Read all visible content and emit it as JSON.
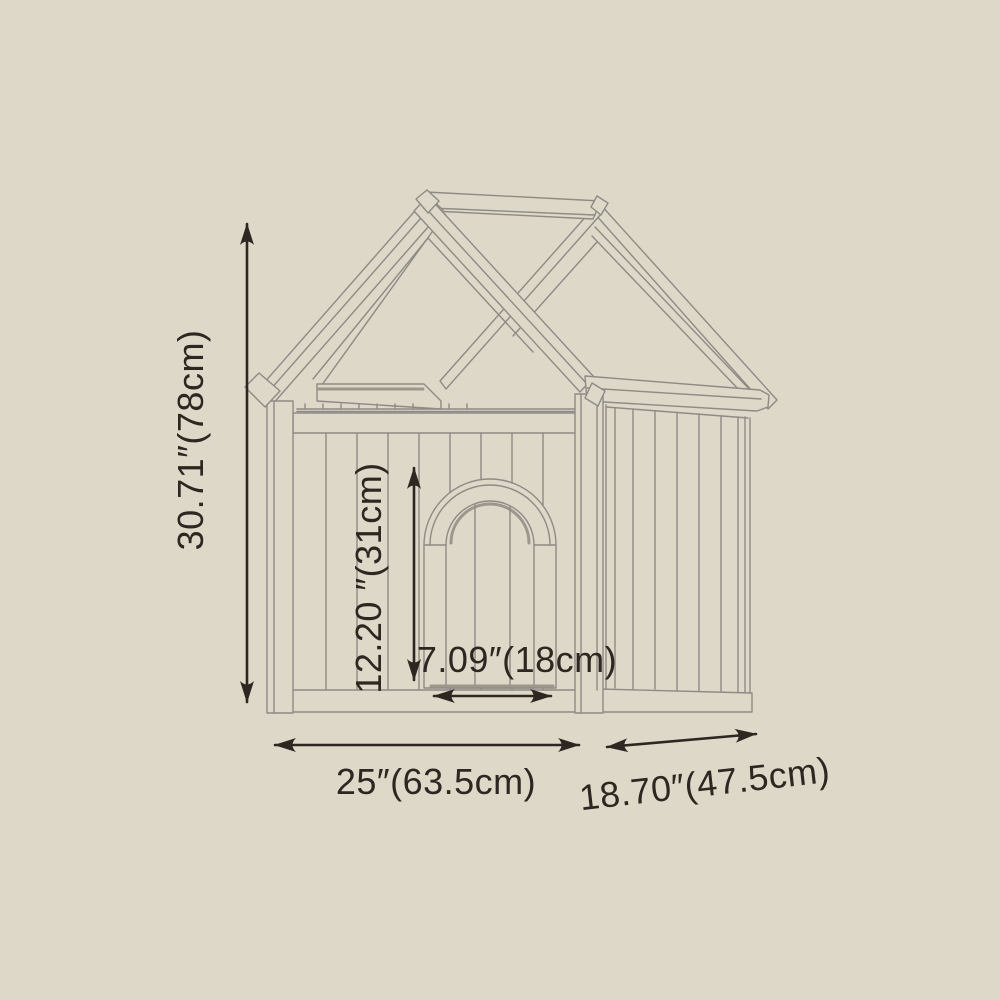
{
  "colors": {
    "background": "#ded8c9",
    "drawing_line": "#8e8a85",
    "drawing_line_strong": "#9c968c",
    "dimension_ink": "#2e2621"
  },
  "diagram": {
    "subject": "wooden-dog-house-gable-roof-dimension-drawing",
    "dimensions": {
      "overall_height": {
        "label": "30.71″(78cm)",
        "orientation": "vertical"
      },
      "door_height": {
        "label": "12.20 ″(31cm)",
        "orientation": "vertical"
      },
      "door_width": {
        "label": "7.09″(18cm)",
        "orientation": "horizontal"
      },
      "overall_width": {
        "label": "25″(63.5cm)",
        "orientation": "horizontal"
      },
      "overall_depth": {
        "label": "18.70″(47.5cm)",
        "orientation": "slanted"
      }
    }
  }
}
